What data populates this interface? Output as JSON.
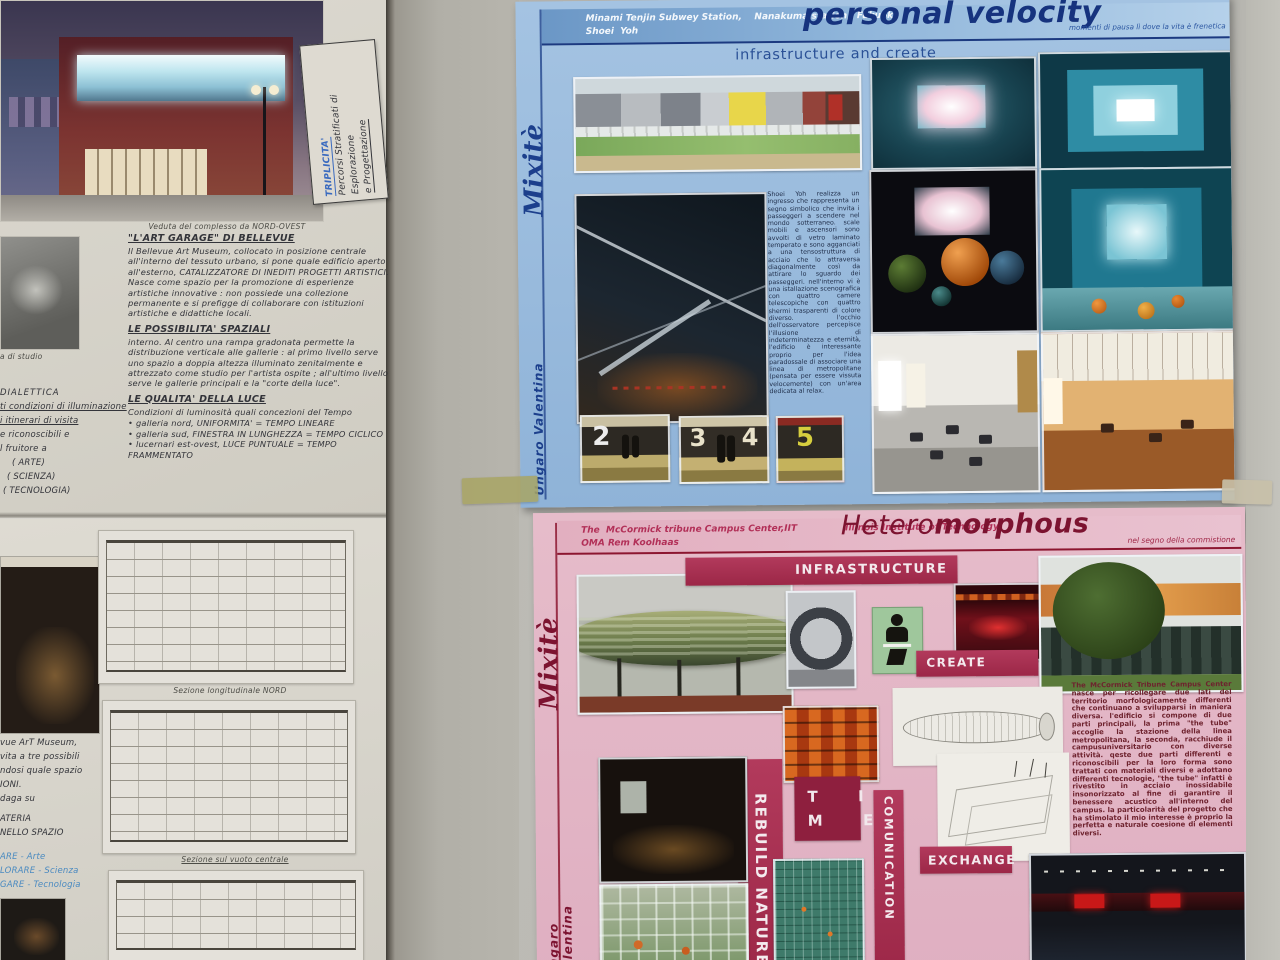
{
  "left_board": {
    "building_photo_caption": "Veduta del complesso da NORD-OVEST",
    "note_card": {
      "title": "TRIPLICITA'",
      "line2": "Percorsi Stratificati di Esplorazione",
      "line3": "e Progettazione"
    },
    "model_caption_fragment": "a di studio",
    "edge_fragments": [
      "DIALETTICA",
      "ti condizioni di illuminazione",
      "i itinerari di visita",
      "e riconoscibili e",
      "l fruitore a",
      "( ARTE)",
      "( SCIENZA)",
      "( TECNOLOGIA)"
    ],
    "notes": {
      "heading_art_garage": "\"L'ART GARAGE\" DI BELLEVUE",
      "para_art_garage": "Il Bellevue Art Museum, collocato in posizione centrale all'interno del tessuto urbano, si pone quale edificio aperto all'esterno, CATALIZZATORE DI INEDITI PROGETTI ARTISTICI. Nasce come spazio per la promozione di esperienze artistiche innovative : non possiede una collezione permanente e si prefigge di collaborare con istituzioni artistiche e didattiche locali.",
      "heading_spazi": "LE POSSIBILITA' SPAZIALI",
      "para_spazi": "interno. Al centro una rampa gradonata permette la distribuzione verticale alle gallerie : al primo livello serve uno spazio a doppia altezza illuminato zenitalmente e attrezzato come studio per l'artista ospite ; all'ultimo livello serve le gallerie principali e la \"corte della luce\".",
      "heading_luce": "LE QUALITA' DELLA LUCE",
      "para_luce": "Condizioni di luminosità quali concezioni del Tempo",
      "bullet1": "galleria nord, UNIFORMITA' = TEMPO LINEARE",
      "bullet2": "galleria sud, FINESTRA IN LUNGHEZZA = TEMPO CICLICO",
      "bullet3": "lucernari est-ovest, LUCE PUNTUALE = TEMPO FRAMMENTATO"
    }
  },
  "lower_board": {
    "section_caption_1": "Sezione longitudinale NORD",
    "section_caption_2": "Sezione sul vuoto centrale",
    "fragments": [
      "vue ArT Museum,",
      "vita a tre possibili",
      "ndosi quale spazio",
      "IONI.",
      "daga su",
      "ATERIA",
      "NELLO SPAZIO"
    ],
    "blue_fragments": [
      "ARE  - Arte",
      "LORARE - Scienza",
      "GARE - Tecnologia"
    ]
  },
  "blue_poster": {
    "station_line1": "Minami Tenjin Subwey Station,    Nanakuma station,  Fukuoka",
    "station_line2": "Shoei  Yoh",
    "title": "personal velocity",
    "tagline": "momenti di pausa lì dove la vita è frenetica",
    "side_label": "Mixitè",
    "author": "Ungaro Valentina",
    "section_heading": "infrastructure and create",
    "body": "Shoei Yoh realizza un ingresso che rappresenta un segno simbolico che invita i passeggeri a scendere nel mondo sotterraneo. scale mobili e ascensori sono avvolti di vetro laminato temperato e sono agganciati a una tensostruttura di acciaio che lo attraversa diagonalmente così da attirare lo sguardo dei passeggeri. nell'interno vi è una istallazione scenografica con quattro camere telescopiche con quattro shermi trasparenti di colore diverso. l'occhio dell'osservatore percepisce l'illusione di indeterminatezza e eternità, l'edificio è interessante proprio per l'idea paradossale di associare una linea di metropolitane (pensata per essere vissuta velocemente) con un'area dedicata al relax.",
    "platform_numbers": [
      "2",
      "3",
      "4",
      "5"
    ]
  },
  "pink_poster": {
    "project_line1": "The  McCormick tribune Campus Center,IIT",
    "institute": "Illinois Institute of Technology",
    "project_line2": "OMA Rem Koolhaas",
    "title_regular": "Hetero",
    "title_bold": "morphous",
    "tagline": "nel segno della commistione",
    "side_label": "Mixitè",
    "author": "Ungaro Valentina",
    "banner_infrastructure": "INFRASTRUCTURE",
    "banner_create": "CREATE",
    "time_line1": "T  I",
    "time_line2": "M  E",
    "banner_rebuild": "REBUILD NATURE",
    "banner_comunication": "COMUNICATION",
    "banner_exchange": "EXCHANGE",
    "body": "The McCormick Tribune Campus Center nasce per ricollegare due lati del territorio morfologicamente differenti che continuano a svilupparsi in maniera diversa. l'edificio si compone di due parti principali, la prima \"the tube\" accoglie la stazione della linea metropolitana, la seconda, racchiude il campusuniversitario con diverse attività. qeste due parti differenti e riconoscibili per la loro forma sono trattati con materiali diversi e adottano differenti tecnologie, \"the tube\" infatti è rivestito in acciaio inossidabile insonorizzato al fine di garantire il benessere acustico all'interno del campus. la particolarità del progetto che ha stimolato il mio interesse è proprio la perfetta e naturale coesione di elementi diversi."
  },
  "colors": {
    "blue_accent": "#1c3a80",
    "pink_accent": "#a92e52",
    "maroon": "#7c1532"
  }
}
